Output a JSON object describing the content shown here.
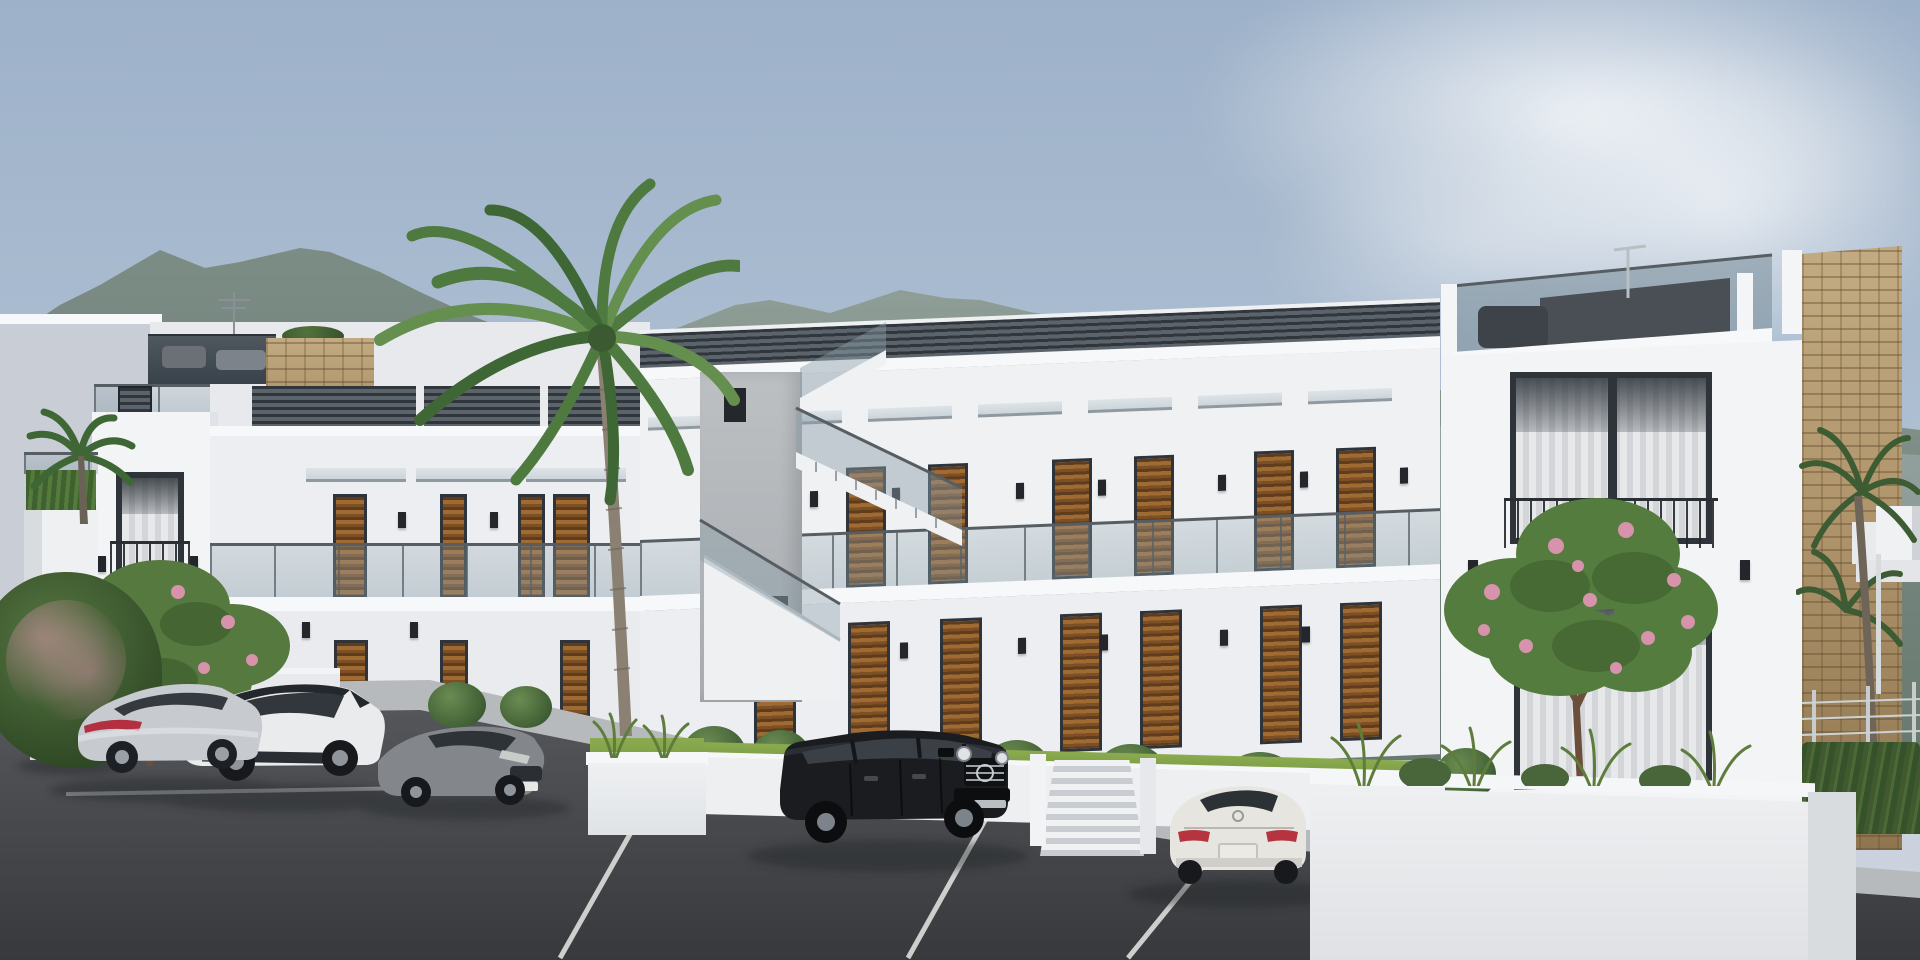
{
  "meta": {
    "kind": "architectural-render",
    "width": 1920,
    "height": 960,
    "visible_text": "none"
  },
  "palette": {
    "sky_top": "#9db1c9",
    "sky_mid": "#aebfd2",
    "sky_low": "#c6cedb",
    "mountain": "#75867f",
    "mountain_light": "#93a29b",
    "wall_white": "#f3f4f6",
    "wall_shaded": "#c9cdd5",
    "window_frame": "#2e3439",
    "wood_shutter": "#a06a33",
    "glass_balustrade": "rgba(138,158,168,0.42)",
    "concrete": "#b4b8bb",
    "stone_cladding": "#b2976e",
    "asphalt": "#38393d",
    "pavement": "#b7babc",
    "vegetation": "#4e7a3f",
    "flowers": "#d693ab"
  },
  "scene": {
    "setting": "modern two-storey white apartment complex with roof terraces, mountains behind, parking lot in front",
    "buildings": [
      {
        "name": "far-left-shaded-block"
      },
      {
        "name": "left-tower",
        "features": [
          "roof glass balustrade",
          "louvre vent",
          "two framed windows",
          "hedge planter"
        ]
      },
      {
        "name": "left-wing",
        "features": [
          "roof privacy screens",
          "glass canopies",
          "wooden louvre doors",
          "glass balcony"
        ]
      },
      {
        "name": "central-block",
        "features": [
          "roof privacy screens",
          "7 upper canopied doors",
          "glass balcony",
          "ground-floor wooden doors",
          "entrance stairs"
        ]
      },
      {
        "name": "external-stair-core",
        "features": [
          "board-formed concrete",
          "switchback stairs with glass rails"
        ]
      },
      {
        "name": "right-tower",
        "features": [
          "roof terrace glass with furniture",
          "antenna",
          "large curtained window upper",
          "curtained window ground"
        ]
      },
      {
        "name": "stone-clad-pillar"
      },
      {
        "name": "distant-white-houses"
      }
    ],
    "vehicles": [
      {
        "type": "sedan",
        "color": "dark-red",
        "position": "far-left, mostly hidden by shrub"
      },
      {
        "type": "fastback-sedan",
        "color": "silver",
        "position": "left"
      },
      {
        "type": "crossover-suv",
        "color": "white with black roof",
        "position": "left-center"
      },
      {
        "type": "sedan",
        "color": "grey",
        "position": "center-left"
      },
      {
        "type": "boxy-suv",
        "color": "black",
        "position": "center"
      },
      {
        "type": "luxury-sedan",
        "color": "white",
        "position": "center-right, rear view"
      }
    ],
    "vegetation": [
      {
        "type": "tall-palm",
        "position": "center-left"
      },
      {
        "type": "small-palm",
        "position": "far-left"
      },
      {
        "type": "flowering-tree",
        "position": "left, pink blossoms"
      },
      {
        "type": "flowering-tree",
        "position": "right planter, pink blossoms"
      },
      {
        "type": "round-bushes",
        "count": 9
      },
      {
        "type": "ornamental-grasses",
        "position": "planters"
      },
      {
        "type": "hedge-with-wire-fence",
        "position": "far-right"
      },
      {
        "type": "background-palms",
        "position": "far-right"
      }
    ],
    "ground": {
      "surface": "asphalt parking with white bay lines",
      "walkway": "light concrete paving",
      "planters": "white rendered boxes"
    },
    "weather": {
      "sky": "hazy blue",
      "clouds": "soft, upper right"
    }
  }
}
